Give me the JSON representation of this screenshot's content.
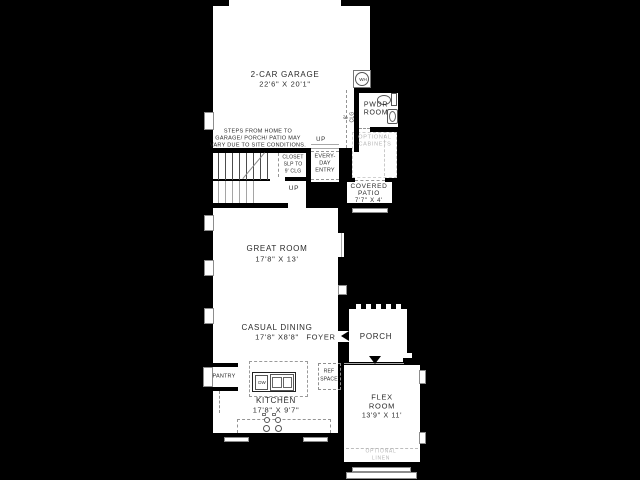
{
  "colors": {
    "background": "#000000",
    "floor": "#ffffff",
    "wall": "#000000",
    "text": "#2b2b2b",
    "muted_text": "#b6b6b6"
  },
  "rooms": {
    "garage": {
      "name": "2-CAR GARAGE",
      "dims": "22'6\" X 20'1\""
    },
    "great_room": {
      "name": "GREAT ROOM",
      "dims": "17'8\" X 13'"
    },
    "casual_dining": {
      "name": "CASUAL DINING",
      "dims": "17'8\" X8'8\""
    },
    "kitchen": {
      "name": "KITCHEN",
      "dims": "17'8\" X 9'7\""
    },
    "flex": {
      "name_line1": "FLEX",
      "name_line2": "ROOM",
      "dims": "13'9\" X 11'"
    },
    "covered_patio": {
      "name_line1": "COVERED",
      "name_line2": "PATIO",
      "dims": "7'7\" X 4'"
    },
    "pwdr": {
      "name_line1": "PWDR",
      "name_line2": "ROOM"
    },
    "foyer": {
      "name": "FOYER"
    },
    "porch": {
      "name": "PORCH"
    },
    "pantry": {
      "name": "PANTRY"
    }
  },
  "annotations": {
    "note_line1": "STEPS FROM HOME TO",
    "note_line2": "GARAGE/ PORCH/ PATIO MAY",
    "note_line3": "VARY DUE TO SITE CONDITIONS.",
    "closet_line1": "CLOSET",
    "closet_line2": "SLP TO",
    "closet_line3": "9' CLG",
    "entry_line1": "EVERY-",
    "entry_line2": "DAY",
    "entry_line3": "ENTRY",
    "optional_cabinets_line1": "OPTIONAL",
    "optional_cabinets_line2": "CABINETS",
    "optional_linen_line1": "OPTIONAL",
    "optional_linen_line2": "LINEN",
    "ref_line1": "REF",
    "ref_line2": "SPACE",
    "clg_line1": "8'",
    "clg_line2": "CLG",
    "up_garage": "UP",
    "up_stairs": "UP",
    "wh": "WH",
    "dw": "DW"
  }
}
